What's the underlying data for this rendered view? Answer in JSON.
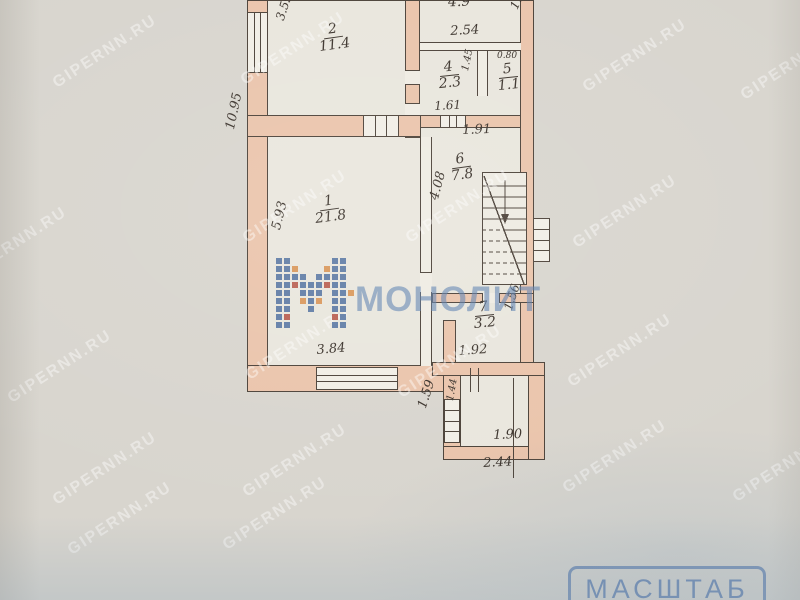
{
  "watermarks": {
    "site_text": "GIPERNN.RU",
    "brand_text": "МОНОЛИТ",
    "positions": [
      [
        45,
        43
      ],
      [
        233,
        40
      ],
      [
        575,
        47
      ],
      [
        733,
        55
      ],
      [
        -45,
        235
      ],
      [
        235,
        198
      ],
      [
        398,
        198
      ],
      [
        565,
        203
      ],
      [
        0,
        358
      ],
      [
        238,
        335
      ],
      [
        390,
        353
      ],
      [
        560,
        342
      ],
      [
        45,
        460
      ],
      [
        235,
        452
      ],
      [
        555,
        448
      ],
      [
        725,
        457
      ],
      [
        60,
        510
      ],
      [
        215,
        505
      ]
    ]
  },
  "stamp": {
    "label": "МАСШТАБ"
  },
  "colors": {
    "paper": "#d8d5ce",
    "room_fill": "#e9e6dd",
    "wall_fill": "#eac4ab",
    "ink": "#3a322b",
    "stamp_blue": "#5476aa",
    "logo_blue": "#4a6b9d",
    "logo_red": "#b24a3c",
    "logo_orange": "#d78b46"
  },
  "plan": {
    "rooms": [
      {
        "id": "room-1",
        "number": "1",
        "area": "21.8",
        "x": 314,
        "y": 194,
        "rot": -8
      },
      {
        "id": "room-2",
        "number": "2",
        "area": "11.4",
        "x": 318,
        "y": 22,
        "rot": -8
      },
      {
        "id": "room-3",
        "number": "",
        "area": "4.9",
        "x": 448,
        "y": -6,
        "rot": -2
      },
      {
        "id": "room-4",
        "number": "4",
        "area": "2.3",
        "x": 438,
        "y": 60,
        "rot": -6
      },
      {
        "id": "room-5",
        "number": "5",
        "area": "1.1",
        "x": 497,
        "y": 62,
        "rot": -6
      },
      {
        "id": "room-6",
        "number": "6",
        "area": "7.8",
        "x": 450,
        "y": 152,
        "rot": -8
      },
      {
        "id": "room-7",
        "number": "7",
        "area": "3.2",
        "x": 473,
        "y": 300,
        "rot": -6
      }
    ],
    "dimensions": [
      {
        "label": "3.59",
        "x": 274,
        "y": 18,
        "rot": -72,
        "s": 12
      },
      {
        "label": "1.9",
        "x": 508,
        "y": 6,
        "rot": -65,
        "s": 12
      },
      {
        "label": "2.54",
        "x": 450,
        "y": 25,
        "rot": -3,
        "s": 13
      },
      {
        "label": "0.80",
        "x": 497,
        "y": 52,
        "rot": 0,
        "s": 9
      },
      {
        "label": "1.45",
        "x": 461,
        "y": 70,
        "rot": -78,
        "s": 10
      },
      {
        "label": "1.61",
        "x": 434,
        "y": 100,
        "rot": -3,
        "s": 12
      },
      {
        "label": "1.91",
        "x": 462,
        "y": 124,
        "rot": -2,
        "s": 13
      },
      {
        "label": "4.08",
        "x": 428,
        "y": 198,
        "rot": -75,
        "s": 13
      },
      {
        "label": "10.95",
        "x": 224,
        "y": 128,
        "rot": -78,
        "s": 13
      },
      {
        "label": "5.93",
        "x": 270,
        "y": 228,
        "rot": -76,
        "s": 13
      },
      {
        "label": "3.84",
        "x": 316,
        "y": 344,
        "rot": -5,
        "s": 13
      },
      {
        "label": "1.56",
        "x": 502,
        "y": 308,
        "rot": -72,
        "s": 12
      },
      {
        "label": "1.92",
        "x": 458,
        "y": 345,
        "rot": -4,
        "s": 13
      },
      {
        "label": "1.59",
        "x": 416,
        "y": 406,
        "rot": -72,
        "s": 13
      },
      {
        "label": "1.44",
        "x": 446,
        "y": 400,
        "rot": -80,
        "s": 10
      },
      {
        "label": "1.90",
        "x": 493,
        "y": 429,
        "rot": -2,
        "s": 13
      },
      {
        "label": "2.44",
        "x": 483,
        "y": 457,
        "rot": -3,
        "s": 13
      }
    ],
    "geometry": [
      {
        "t": "bg",
        "x": 247,
        "y": 0,
        "w": 287,
        "h": 392
      },
      {
        "t": "bg",
        "x": 443,
        "y": 362,
        "w": 102,
        "h": 98
      },
      {
        "t": "wall",
        "x": 247,
        "y": 0,
        "w": 21,
        "h": 14
      },
      {
        "t": "winv",
        "x": 247,
        "y": 12,
        "w": 21,
        "h": 62
      },
      {
        "t": "wall",
        "x": 247,
        "y": 72,
        "w": 21,
        "h": 295
      },
      {
        "t": "wall",
        "x": 247,
        "y": 365,
        "w": 209,
        "h": 27
      },
      {
        "t": "winh",
        "x": 316,
        "y": 367,
        "w": 82,
        "h": 23
      },
      {
        "t": "wall",
        "x": 405,
        "y": 0,
        "w": 15,
        "h": 71
      },
      {
        "t": "gapv",
        "x": 405,
        "y": 70,
        "w": 15,
        "h": 15
      },
      {
        "t": "wall",
        "x": 405,
        "y": 84,
        "w": 15,
        "h": 20
      },
      {
        "t": "gapv",
        "x": 405,
        "y": 103,
        "w": 15,
        "h": 14
      },
      {
        "t": "wall",
        "x": 405,
        "y": 116,
        "w": 15,
        "h": 22
      },
      {
        "t": "wall",
        "x": 247,
        "y": 115,
        "w": 174,
        "h": 22
      },
      {
        "t": "boxv",
        "x": 363,
        "y": 115,
        "w": 36,
        "h": 22
      },
      {
        "t": "wall",
        "x": 520,
        "y": 0,
        "w": 14,
        "h": 376
      },
      {
        "t": "thinh",
        "x": 420,
        "y": 42,
        "w": 101,
        "h": 9
      },
      {
        "t": "thinv",
        "x": 477,
        "y": 51,
        "w": 11,
        "h": 45
      },
      {
        "t": "wall",
        "x": 420,
        "y": 115,
        "w": 101,
        "h": 13
      },
      {
        "t": "boxv",
        "x": 440,
        "y": 115,
        "w": 26,
        "h": 13
      },
      {
        "t": "thinv",
        "x": 420,
        "y": 137,
        "w": 12,
        "h": 137
      },
      {
        "t": "gapv",
        "x": 420,
        "y": 272,
        "w": 12,
        "h": 21
      },
      {
        "t": "thinv",
        "x": 420,
        "y": 292,
        "w": 12,
        "h": 74
      },
      {
        "t": "wall",
        "x": 432,
        "y": 293,
        "w": 102,
        "h": 10
      },
      {
        "t": "gaph",
        "x": 482,
        "y": 293,
        "w": 18,
        "h": 10
      },
      {
        "t": "wall",
        "x": 443,
        "y": 320,
        "w": 13,
        "h": 46
      },
      {
        "t": "wall",
        "x": 432,
        "y": 362,
        "w": 113,
        "h": 14
      },
      {
        "t": "wall",
        "x": 443,
        "y": 375,
        "w": 18,
        "h": 85
      },
      {
        "t": "boxh",
        "x": 444,
        "y": 399,
        "w": 16,
        "h": 44
      },
      {
        "t": "wall",
        "x": 443,
        "y": 446,
        "w": 102,
        "h": 14
      },
      {
        "t": "wall",
        "x": 528,
        "y": 375,
        "w": 17,
        "h": 85
      },
      {
        "t": "boxh",
        "x": 533,
        "y": 218,
        "w": 17,
        "h": 44
      },
      {
        "t": "linev",
        "x": 470,
        "y": 368,
        "h": 24
      },
      {
        "t": "linev",
        "x": 478,
        "y": 368,
        "h": 24
      },
      {
        "t": "linev",
        "x": 513,
        "y": 378,
        "h": 100
      }
    ],
    "logo_grid": [
      "bb.....bb.",
      "bbo...obb.",
      "bbbb.bbbb.",
      "bbrbbbrbb.",
      "bb.bbb.bbo",
      "bb.obo.bb.",
      "bb..b..bb.",
      "br.....rb.",
      "bb.....bb."
    ]
  }
}
